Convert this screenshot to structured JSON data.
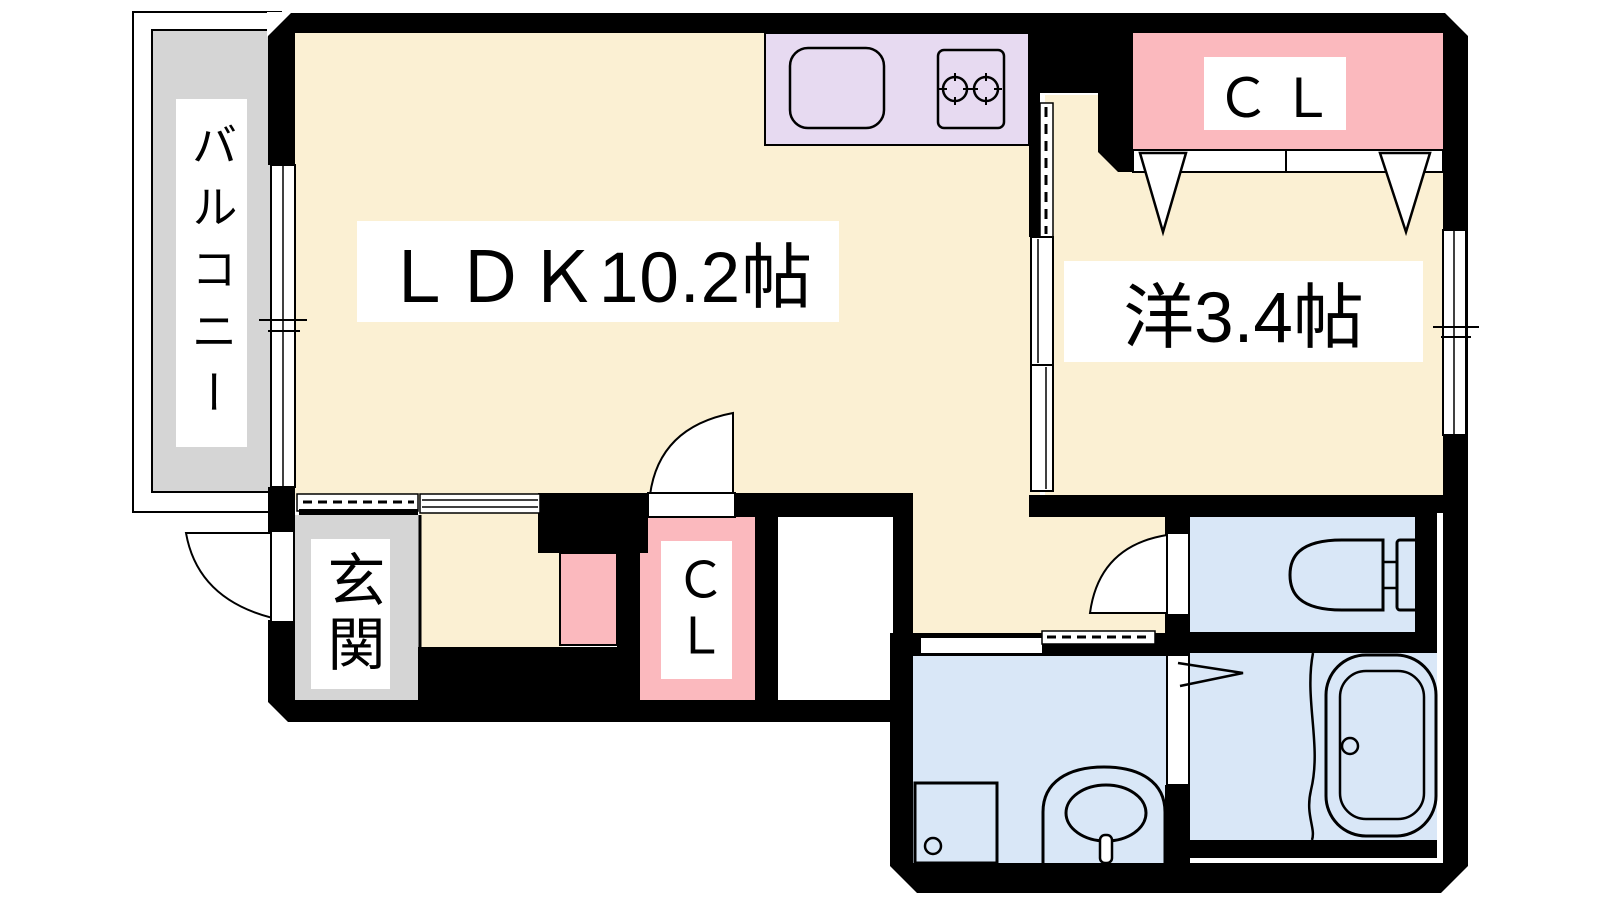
{
  "title": "間取り図 (1LDK apartment floor plan)",
  "labels": {
    "balcony": "バルコニー",
    "ldk": "ＬＤＫ10.2帖",
    "western_room": "洋3.4帖",
    "closet_upper": "ＣＬ",
    "closet_hall": "ＣＬ",
    "entrance": "玄関"
  },
  "colors": {
    "wall": "#000000",
    "line": "#000000",
    "floor_main": "#fbf0d3",
    "kitchen_counter": "#e7daf1",
    "closet_pink": "#fbb9be",
    "balcony_entrance_gray": "#d5d5d5",
    "wet_area_blue": "#d9e7f7",
    "label_background": "#ffffff",
    "background": "#ffffff"
  },
  "fixtures": [
    "kitchen-sink",
    "gas-stove-two-burners",
    "balcony-window",
    "western-room-window",
    "sliding-partition-doors",
    "closet-folding-doors",
    "entrance-swing-door",
    "closet-swing-door",
    "toilet-swing-door",
    "bathroom-folding-door",
    "washroom-sliding-door",
    "toilet",
    "bathtub",
    "wash-basin",
    "washing-machine-pan"
  ]
}
